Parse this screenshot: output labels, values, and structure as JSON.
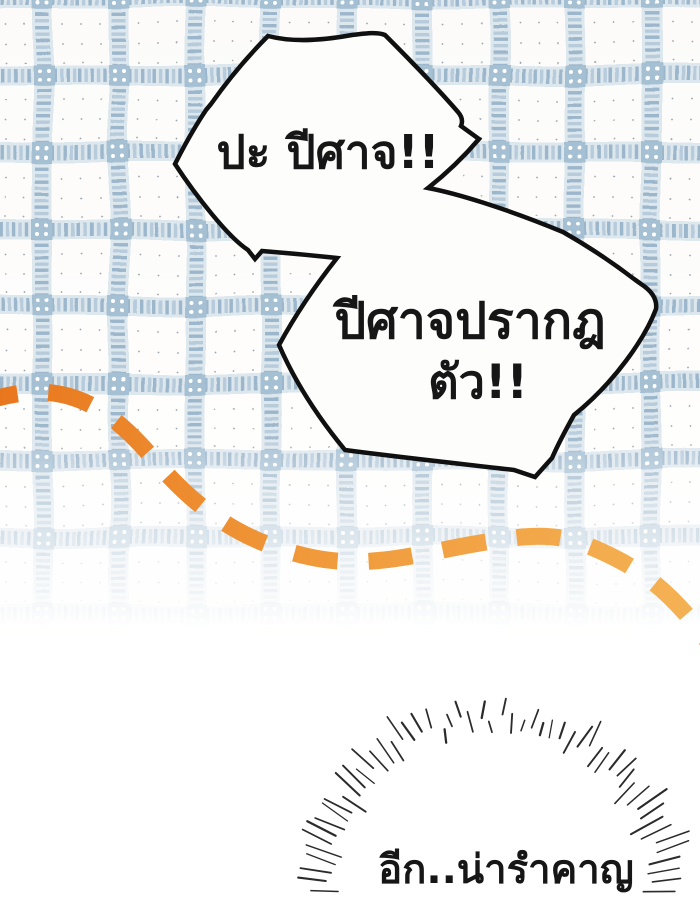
{
  "panel": {
    "kind": "comic-panel"
  },
  "speech": {
    "bubble1": {
      "text": "ปะ ปีศาจ!!"
    },
    "bubble2": {
      "line1": "ปีศาจปรากฎ",
      "line2": "ตัว!!"
    }
  },
  "caption": {
    "text": "อีก..น่ารำคาญ"
  },
  "colors": {
    "page_bg": "#fcfbf9",
    "plaid_band": "#9cb6cb",
    "plaid_band_light": "#b7cbdb",
    "plaid_backing": "#dde7ee",
    "plaid_square": "#a6c0d3",
    "dot_color": "#99a4ac",
    "dash_start": "#e8741b",
    "dash_mid": "#f0993a",
    "dash_end": "#f4b254",
    "bubble_fill": "#fdfdfc",
    "bubble_stroke": "#101010",
    "text_color": "#161616",
    "burst_color": "#2b2b2b"
  }
}
